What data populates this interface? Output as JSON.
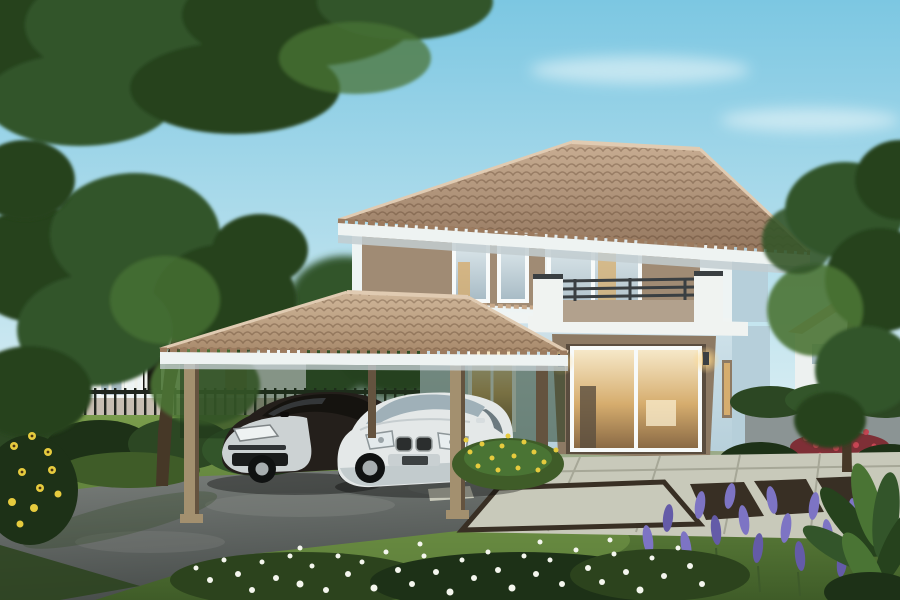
{
  "scene": {
    "type": "architectural-photo-rendering",
    "subject": "two-story-house-with-carport-two-cars-and-garden",
    "objects": [
      "sky",
      "clouds",
      "overhanging-tree-canopy",
      "neighbor-house-left",
      "metal-fence",
      "hedge-row",
      "main-house",
      "hip-roof",
      "balcony",
      "sliding-glass-door",
      "wall-lamps",
      "carport",
      "dark-sedan",
      "white-sedan",
      "driveway",
      "lawn",
      "stone-patio",
      "white-flowers",
      "purple-flowers",
      "yellow-flowers",
      "red-flowers",
      "sunflowers",
      "distant-house-right",
      "right-tree",
      "foreground-leaf-plant"
    ]
  },
  "palette": {
    "sky_top": "#7cc7e2",
    "sky_horizon": "#daeef3",
    "cloud": "#f2fafb",
    "canopy_dark": "#26421d",
    "canopy_mid": "#33552a",
    "canopy_light": "#4a7434",
    "canopy_deep": "#1c3317",
    "branch": "#4a3b28",
    "bg_tree": "#2f4f27",
    "grass_light": "#7a9d4c",
    "grass_mid": "#5d7f3a",
    "grass_dark": "#3f5c28",
    "grass_shadow": "#2c431d",
    "drive_light": "#7d827e",
    "drive_mid": "#5c6260",
    "drive_dark": "#474c4a",
    "roof_hi": "#c9ae93",
    "roof_lo": "#93765e",
    "roof_edge": "#e0cbb2",
    "carport_roof_hi": "#d0b79a",
    "carport_roof_lo": "#a88a6c",
    "fascia": "#eef3f2",
    "soffit": "#c2ccd0",
    "wall_white": "#eef4f4",
    "wall_blue": "#cfe2ea",
    "wall_blue_dark": "#b6cfda",
    "floor_band": "#f0f4f3",
    "panel_brown": "#a08b74",
    "panel_brown_dark": "#85715c",
    "door_brown": "#8d7a64",
    "door_recess": "#5a4d3f",
    "glass_cool_hi": "#e2ecef",
    "glass_cool_lo": "#a9bcc6",
    "glass_warm_hi": "#f6e8c8",
    "glass_warm_mid": "#d6ad6e",
    "glass_warm_lo": "#8a6a45",
    "frame_white": "#f7fafa",
    "rail_dark": "#3a3f42",
    "balcony_panel": "#b2a18d",
    "parapet": "#f0f3f1",
    "post_tan": "#a3906f",
    "post_dark": "#64533f",
    "fence": "#20261e",
    "hedge": "#2c4723",
    "hedge_dark": "#1d3117",
    "car_dark_body": "#241f1b",
    "car_dark_glass": "#15130f",
    "car_silver": "#ccd2d3",
    "car_white_body": "#e4e8e8",
    "car_white_shade": "#b4bfc2",
    "car_glass": "#9fb0b8",
    "grille_dark": "#2b2e2e",
    "wheel": "#101212",
    "alloy": "#a7aeb0",
    "stone": "#c8c9ba",
    "stone_joint": "#a6a797",
    "stone_dark": "#382f24",
    "plinth": "#9aaa88",
    "flower_white": "#f4f6ee",
    "flower_purple": "#7d74c4",
    "flower_purple_dark": "#645ba8",
    "flower_yellow": "#e6cb3e",
    "flower_red": "#c64553",
    "flower_red_dark": "#7e2f36",
    "distant_roof": "#c8ab88",
    "distant_wall": "#edf1f0",
    "wall_gray": "#8b9494",
    "lamp_glow": "#ffd98a",
    "trunk": "#463827"
  }
}
